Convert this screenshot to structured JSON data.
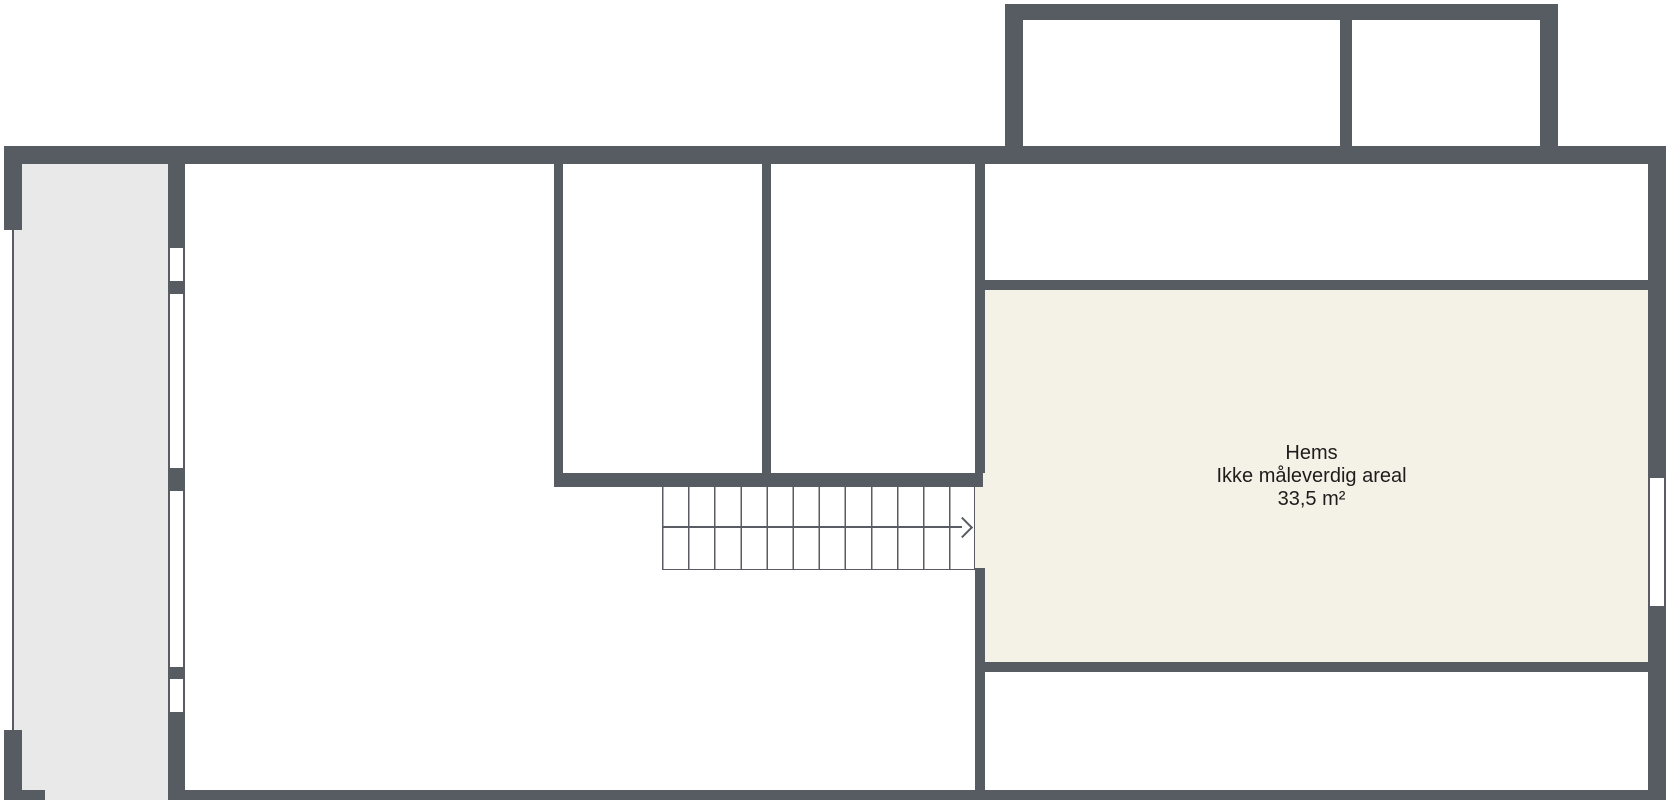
{
  "plan": {
    "room_label": {
      "name": "Hems",
      "note": "Ikke måleverdig areal",
      "area": "33,5 m²"
    },
    "colors": {
      "wall": "#575b62",
      "line": "#595d63",
      "balcony_fill": "#e9e9e9",
      "hems_fill": "#f4f1e7",
      "text": "#1d1d1b",
      "background": "#ffffff"
    }
  }
}
